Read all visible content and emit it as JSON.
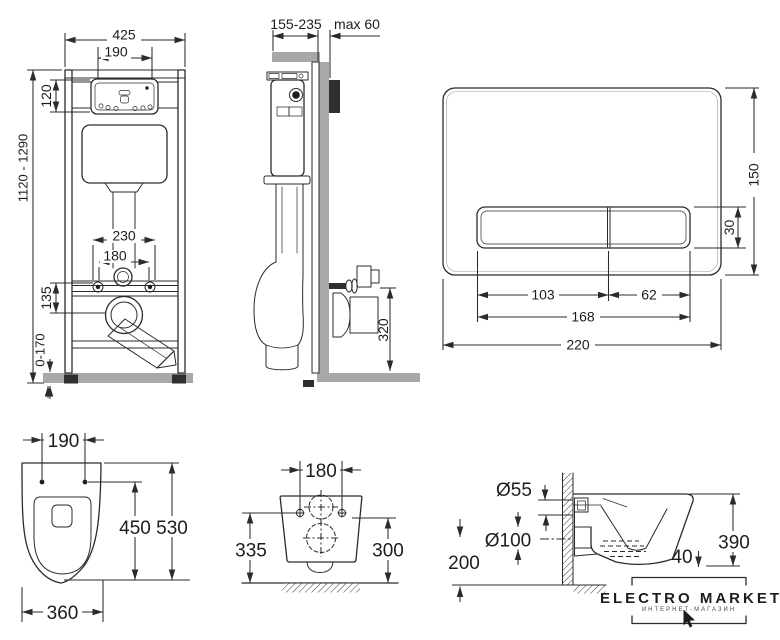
{
  "views": {
    "frame_front": {
      "dims": {
        "overall_width": "425",
        "upper_opening": "190",
        "panel_height": "120",
        "frame_height_range": "1120 - 1290",
        "fixing_spread": "230",
        "fixing_spacing": "180",
        "drain_drop": "135",
        "leg_adjust": "0-170"
      }
    },
    "frame_side": {
      "dims": {
        "depth_range": "155-235",
        "wall_offset": "max 60",
        "outlet_height": "320"
      }
    },
    "flush_plate": {
      "dims": {
        "plate_height": "150",
        "button_height": "30",
        "button_left_width": "103",
        "button_right_width": "62",
        "buttons_width": "168",
        "plate_width": "220"
      }
    },
    "bowl_top": {
      "dims": {
        "fixing_spacing": "190",
        "inner_depth": "450",
        "total_depth": "530",
        "width": "360"
      }
    },
    "bowl_rear": {
      "dims": {
        "fixing_spacing": "180",
        "height_left": "335",
        "height_right": "300"
      }
    },
    "bowl_side": {
      "dims": {
        "inlet_diameter": "Ø55",
        "outlet_diameter": "Ø100",
        "outlet_axis_height": "200",
        "body_height": "390",
        "clearance": "40"
      }
    }
  },
  "logo": {
    "brand": "ELECTRO MARKET",
    "tagline": "ИНТЕРНЕТ-МАГАЗИН"
  }
}
